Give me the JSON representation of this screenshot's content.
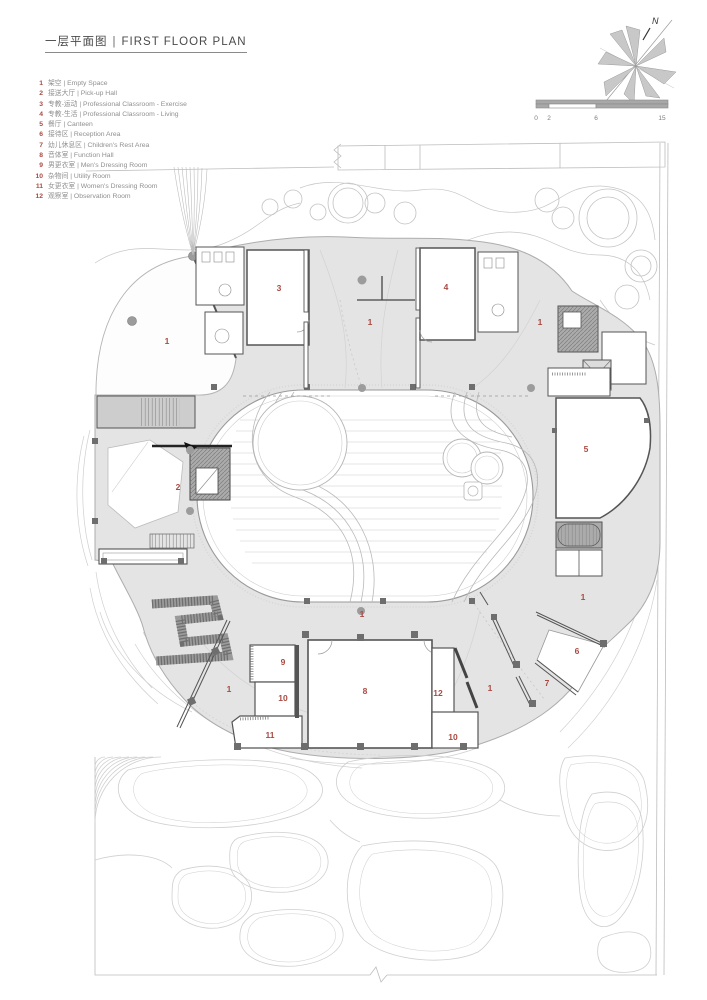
{
  "header": {
    "title_zh": "一层平面图",
    "divider": "|",
    "title_en": "FIRST FLOOR PLAN"
  },
  "legend": {
    "items": [
      {
        "num": "1",
        "zh": "架空",
        "en": "Empty Space"
      },
      {
        "num": "2",
        "zh": "接送大厅",
        "en": "Pick-up Hall"
      },
      {
        "num": "3",
        "zh": "专教-运动",
        "en": "Professional Classroom - Exercise"
      },
      {
        "num": "4",
        "zh": "专教-生活",
        "en": "Professional Classroom - Living"
      },
      {
        "num": "5",
        "zh": "餐厅",
        "en": "Canteen"
      },
      {
        "num": "6",
        "zh": "接待区",
        "en": "Reception Area"
      },
      {
        "num": "7",
        "zh": "幼儿休息区",
        "en": "Children's Rest Area"
      },
      {
        "num": "8",
        "zh": "音体室",
        "en": "Function Hall"
      },
      {
        "num": "9",
        "zh": "男更衣室",
        "en": "Men's Dressing Room"
      },
      {
        "num": "10",
        "zh": "杂物间",
        "en": "Utility Room"
      },
      {
        "num": "11",
        "zh": "女更衣室",
        "en": "Women's Dressing Room"
      },
      {
        "num": "12",
        "zh": "观察室",
        "en": "Observation Room"
      }
    ],
    "separator": "|"
  },
  "compass": {
    "label": "N"
  },
  "scalebar": {
    "ticks": [
      {
        "label": "0",
        "x": 6
      },
      {
        "label": "2",
        "x": 19
      },
      {
        "label": "6",
        "x": 66
      },
      {
        "label": "15",
        "x": 132
      }
    ]
  },
  "plan": {
    "labels": [
      {
        "text": "1",
        "x": 167,
        "y": 341
      },
      {
        "text": "3",
        "x": 279,
        "y": 288
      },
      {
        "text": "1",
        "x": 370,
        "y": 322
      },
      {
        "text": "4",
        "x": 446,
        "y": 287
      },
      {
        "text": "1",
        "x": 540,
        "y": 322
      },
      {
        "text": "2",
        "x": 178,
        "y": 487
      },
      {
        "text": "5",
        "x": 586,
        "y": 449
      },
      {
        "text": "1",
        "x": 583,
        "y": 597
      },
      {
        "text": "1",
        "x": 362,
        "y": 614
      },
      {
        "text": "6",
        "x": 577,
        "y": 651
      },
      {
        "text": "9",
        "x": 283,
        "y": 662
      },
      {
        "text": "7",
        "x": 547,
        "y": 683
      },
      {
        "text": "8",
        "x": 365,
        "y": 691
      },
      {
        "text": "12",
        "x": 438,
        "y": 693
      },
      {
        "text": "10",
        "x": 283,
        "y": 698
      },
      {
        "text": "1",
        "x": 229,
        "y": 689
      },
      {
        "text": "1",
        "x": 490,
        "y": 688
      },
      {
        "text": "11",
        "x": 270,
        "y": 735
      },
      {
        "text": "10",
        "x": 453,
        "y": 737
      }
    ]
  },
  "colors": {
    "accent_red": "#a94a42",
    "text_gray": "#8f8f8f",
    "fill_light": "#e4e4e4",
    "fill_core": "#ababab",
    "line_light": "#b5b5b5",
    "line_dark": "#555555"
  }
}
